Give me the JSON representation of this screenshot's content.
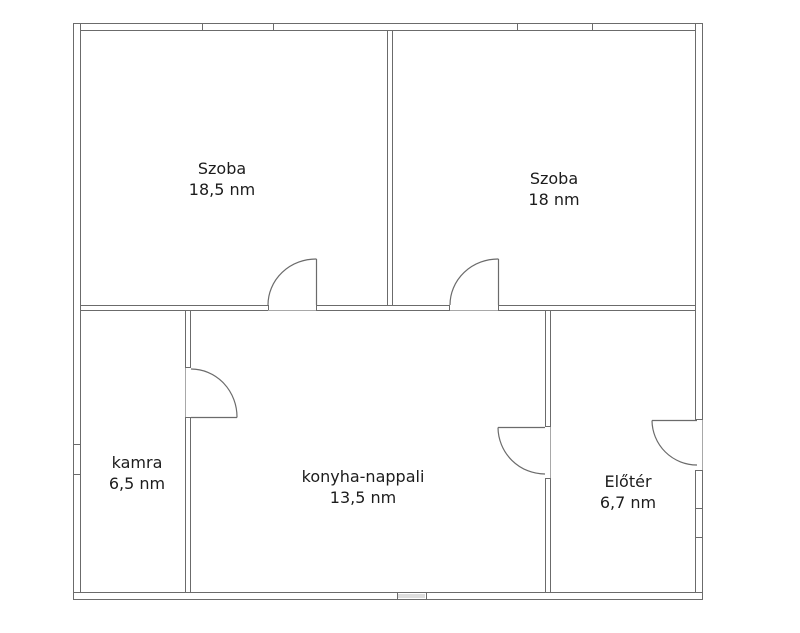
{
  "plan": {
    "rooms": [
      {
        "name": "Szoba",
        "area": "18,5 nm"
      },
      {
        "name": "Szoba",
        "area": "18 nm"
      },
      {
        "name": "kamra",
        "area": "6,5 nm"
      },
      {
        "name": "konyha-nappali",
        "area": "13,5 nm"
      },
      {
        "name": "Előtér",
        "area": "6,7 nm"
      }
    ],
    "unit": "nm",
    "colors": {
      "wall_line": "#6b6b6b",
      "threshold_line": "#a8a8a8",
      "window_fill": "#dddddd",
      "text": "#1c1c1c",
      "background": "#ffffff"
    }
  }
}
